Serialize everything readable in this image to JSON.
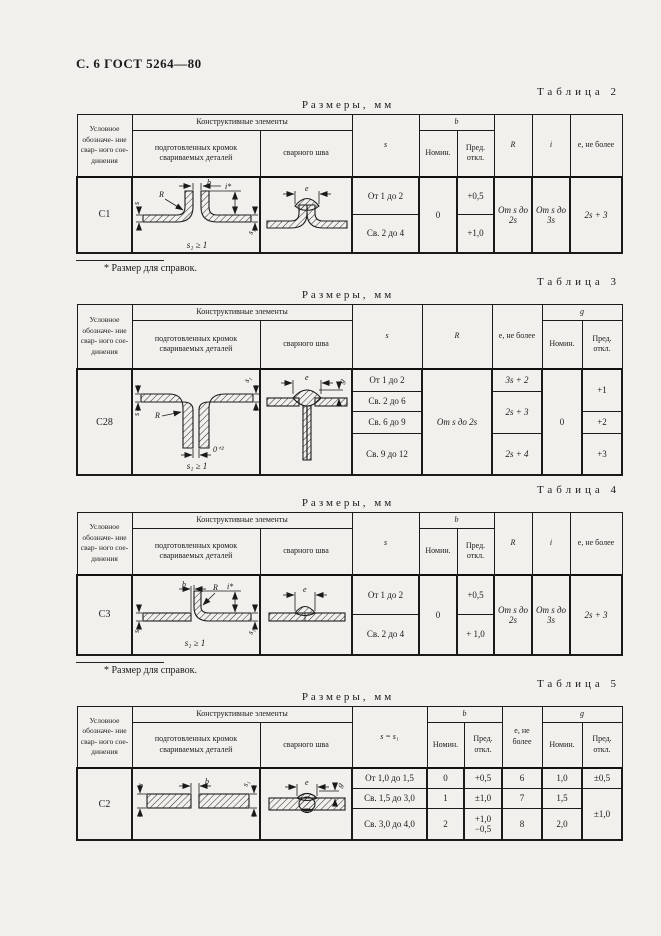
{
  "page": {
    "header_title": "С. 6 ГОСТ 5264—80",
    "sizes_label": "Размеры, мм",
    "footnote": "* Размер для справок."
  },
  "headers": {
    "designation": "Условное обозначе- ние свар- ного сое- динения",
    "elements": "Конструктивные элементы",
    "prep": "подготовленных кромок свариваемых деталей",
    "weld": "сварного шва",
    "nominal": "Номин.",
    "deviation": "Пред. откл.",
    "s": "s",
    "s_eq": "s = s₁",
    "b": "b",
    "r": "R",
    "i": "i",
    "e_max": "e, не более",
    "g": "g"
  },
  "t2": {
    "caption": "Таблица 2",
    "row": {
      "code": "С1",
      "s_ranges": [
        "От 1 до 2",
        "Св. 2 до 4"
      ],
      "b_nom": "0",
      "b_dev": [
        "+0,5",
        "+1,0"
      ],
      "r_val": "От s до 2s",
      "i_val": "От s до 3s",
      "e_val": "2s + 3"
    }
  },
  "t3": {
    "caption": "Таблица 3",
    "row": {
      "code": "С28",
      "s_ranges": [
        "От 1 до 2",
        "Св. 2 до 6",
        "Св. 6 до 9",
        "Св. 9 до 12"
      ],
      "r_val": "От s до 2s",
      "e_vals": [
        "3s + 2",
        "2s + 3",
        "2s + 4"
      ],
      "g_nom": "0",
      "g_dev": [
        "+1",
        "+2",
        "+3"
      ]
    }
  },
  "t4": {
    "caption": "Таблица 4",
    "row": {
      "code": "С3",
      "s_ranges": [
        "От 1 до 2",
        "Св. 2 до 4"
      ],
      "b_nom": "0",
      "b_dev": [
        "+0,5",
        "+ 1,0"
      ],
      "r_val": "От s до 2s",
      "i_val": "От s до 3s",
      "e_val": "2s + 3"
    }
  },
  "t5": {
    "caption": "Таблица 5",
    "row_code": "С2",
    "rows": [
      {
        "s": "От 1,0 до 1,5",
        "b_nom": "0",
        "b_dev": "+0,5",
        "e": "6",
        "g_nom": "1,0"
      },
      {
        "s": "Св. 1,5 до 3,0",
        "b_nom": "1",
        "b_dev": "±1,0",
        "e": "7",
        "g_nom": "1,5"
      },
      {
        "s": "Св. 3,0 до 4,0",
        "b_nom": "2",
        "b_dev": "+1,0\n−0,5",
        "e": "8",
        "g_nom": "2,0"
      }
    ],
    "g_dev": [
      "±0,5",
      "±1,0"
    ]
  },
  "diagrams": {
    "c1_prep": {
      "b": "b",
      "i": "i*",
      "r": "R",
      "s": "s",
      "s1": "s₁",
      "caption": "s₁ ≥ 1"
    },
    "c1_weld": {
      "e": "e"
    },
    "c28_prep": {
      "s": "s",
      "s1": "s₁",
      "r": "R",
      "gap": "0⁺²",
      "caption": "s₁ ≥ 1"
    },
    "c28_weld": {
      "e": "e",
      "g": "g"
    },
    "c3_prep": {
      "b": "b",
      "r": "R",
      "i": "i*",
      "s": "s",
      "s1": "s₁",
      "caption": "s₁ ≥ 1"
    },
    "c3_weld": {
      "e": "e"
    },
    "c2_prep": {
      "s": "s",
      "b": "b",
      "s1": "s₁"
    },
    "c2_weld": {
      "e": "e",
      "g": "g"
    }
  }
}
